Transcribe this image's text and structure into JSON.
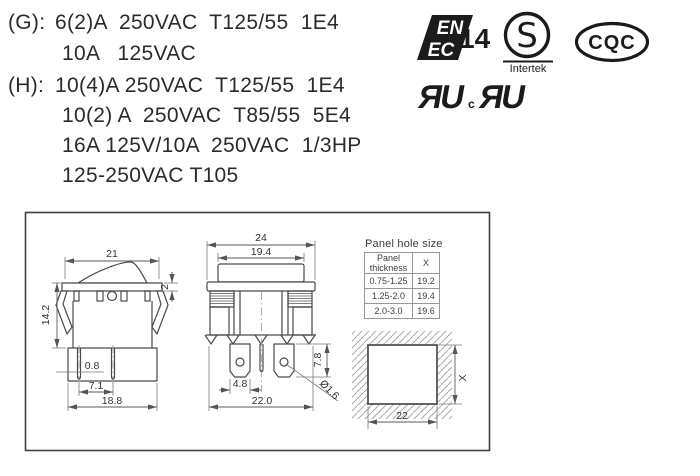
{
  "ratings": {
    "g_label": "(G):",
    "g_line1": "6(2)A  250VAC  T125/55  1E4",
    "g_line2": "10A   125VAC",
    "h_label": "(H):",
    "h_line1": "10(4)A 250VAC  T125/55  1E4",
    "h_line2": "10(2) A  250VAC  T85/55  5E4",
    "h_line3": "16A 125V/10A  250VAC  1/3HP",
    "h_line4": "125-250VAC T105"
  },
  "certifications": {
    "enec": {
      "top": "EN",
      "bottom": "EC",
      "number": "14"
    },
    "intertek": {
      "letter": "S",
      "name": "Intertek"
    },
    "cqc": {
      "label": "CQC"
    },
    "ul_us": "ЯU",
    "ul_c_prefix": "c",
    "ul_ca": "ЯU"
  },
  "side_view": {
    "width_top": "21",
    "bezel_h": "2",
    "height": "14.2",
    "term_t": "0.8",
    "term_pitch": "7.1",
    "width_body": "18.8"
  },
  "front_view": {
    "width_top": "24",
    "width_rocker": "19.4",
    "term_h": "7.8",
    "term_w": "4.8",
    "width_body": "22.0",
    "hole": "Ø1.6"
  },
  "panel_table": {
    "title": "Panel hole size",
    "col1": "Panel thickness",
    "col2": "X",
    "rows": [
      [
        "0.75-1.25",
        "19.2"
      ],
      [
        "1.25-2.0",
        "19.4"
      ],
      [
        "2.0-3.0",
        "19.6"
      ]
    ]
  },
  "cutout": {
    "width": "22",
    "height": "X"
  }
}
